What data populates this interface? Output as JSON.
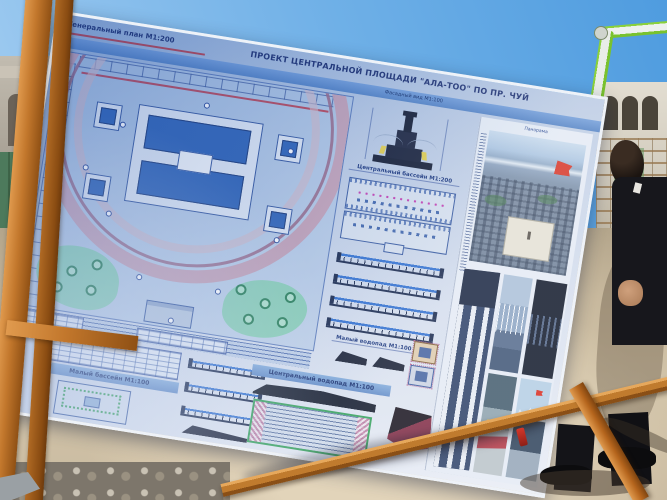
{
  "board": {
    "header": {
      "left_label": "Генеральный план М1:200",
      "title": "ПРОЕКТ ЦЕНТРАЛЬНОЙ ПЛОЩАДИ \"АЛА-ТОО\" ПО ПР. ЧУЙ",
      "subtitle": "Фасадный вид М1:100"
    },
    "sections": {
      "central_basin": "Центральный бассейн М1:200",
      "small_waterfall": "Малый водопад М1:100",
      "small_basin": "Малый бассейн М1:100",
      "central_waterfall": "Центральный водопад М1:100"
    },
    "photos": {
      "caption": "Панорама"
    }
  },
  "colors": {
    "board_paper": "#d4dded",
    "line_navy": "#24418c",
    "pool_blue": "#2f63b6",
    "promenade_pink": "#c49cb0",
    "greenery": "#86cdb4",
    "tree_green": "#1f7a50",
    "accent_red": "#b5404e",
    "nozzle_magenta": "#c23ab0",
    "highlight_yellow": "#e2ce4a",
    "wood_orange": "#c2772c",
    "flag_red": "#d63426",
    "sky_blue": "#6fb0e7",
    "ground_sand": "#cfc0a6",
    "suit_black": "#15151a"
  }
}
